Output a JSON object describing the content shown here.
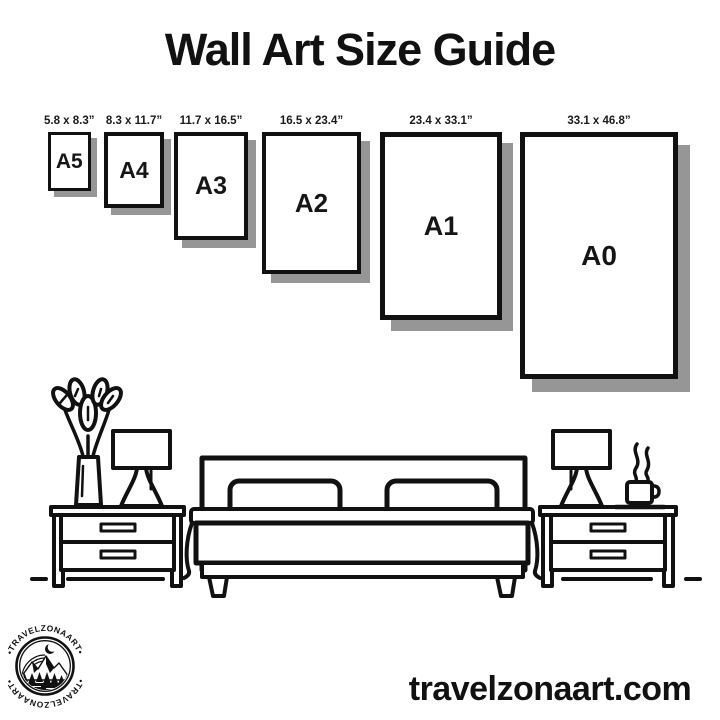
{
  "title": "Wall Art Size Guide",
  "sizes": [
    {
      "label": "A5",
      "dimensions": "5.8 x 8.3”"
    },
    {
      "label": "A4",
      "dimensions": "8.3 x 11.7”"
    },
    {
      "label": "A3",
      "dimensions": "11.7 x 16.5”"
    },
    {
      "label": "A2",
      "dimensions": "16.5 x 23.4”"
    },
    {
      "label": "A1",
      "dimensions": "23.4 x 33.1”"
    },
    {
      "label": "A0",
      "dimensions": "33.1 x 46.8”"
    }
  ],
  "footer": {
    "website": "travelzonaart.com"
  },
  "logo": {
    "arc_text_top": "•TRAVELZONAART•",
    "arc_text_bottom": "•TRAVELZONAART•"
  },
  "colors": {
    "ink": "#111111",
    "paper_shadow": "#969696",
    "background": "#ffffff"
  },
  "illustration": {
    "icons": [
      "vase-plant-icon",
      "table-lamp-icon",
      "nightstand-icon",
      "bed-icon",
      "pillow-icon",
      "coffee-cup-icon",
      "steam-icon",
      "floor-line"
    ]
  }
}
